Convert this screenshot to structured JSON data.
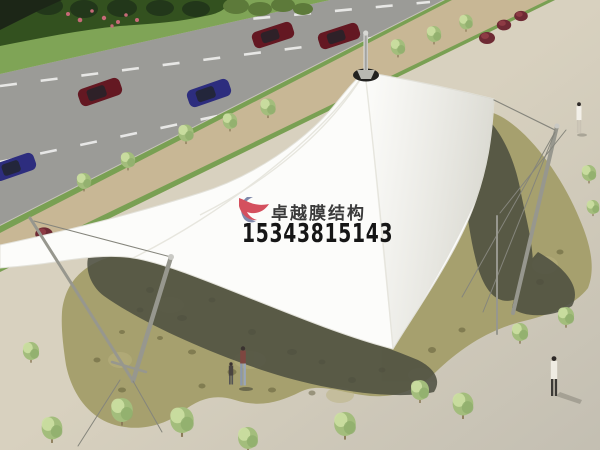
{
  "meta": {
    "description": "Aerial architectural rendering of a white tensile membrane canopy structure with a conical peak, standing over an olive flagstone plaza beside a multi-lane road",
    "style": "3D render, daytime"
  },
  "watermark": {
    "company_name": "卓越膜结构",
    "phone_number": "15343815143",
    "logo": "red and blue-gray swoosh monogram"
  },
  "scene": {
    "road": {
      "lane_markings": "white dashed lines",
      "cars": [
        "dark-teal",
        "dark-red",
        "dark-red",
        "dark-red",
        "blue",
        "navy"
      ]
    },
    "landscaping": {
      "street_trees": 8,
      "plaza_trees": 12,
      "burgundy_bushes": 7,
      "hedge": "dark green hedge with pink flowers, top-left"
    },
    "structure": {
      "membrane": "white tensile canopy with curved cable edges",
      "peak": "conical peak with dark collar and silver finial mast",
      "masts": "two tilted steel masts with guy cables"
    },
    "people": [
      "adult with child walking under canopy",
      "pedestrian in white, upper right plaza",
      "pedestrian in white coat, lower right plaza"
    ]
  },
  "colors": {
    "plaza": "#d8d1bf",
    "road": "#9b9b97",
    "roadLine": "#f0f0ee",
    "grass": "#7fa456",
    "grassStrip": "#79a053",
    "hedge": "#33511f",
    "hedgeDark": "#22371a",
    "flower": "#c66a78",
    "sidewalk": "#c8b795",
    "stone": "#a6a06e",
    "stoneSpot": "#55512f",
    "stoneLight": "#b9b27f",
    "shadow": "#4b4d3f",
    "canopy": "#fcfcfa",
    "ridge": "#e2e1d8",
    "collar": "#222220",
    "mast": "#97978e",
    "cable": "#85857c",
    "treeCrown": "#a3bd7c",
    "treeLight": "#ccdfa2",
    "treeDark": "#8fae6c",
    "trunk": "#8b7b58",
    "bushRed": "#6e2a34",
    "bushRedLight": "#8d3b44",
    "carRed": "#641822",
    "carBlue": "#2d2d7e",
    "carTeal": "#24424a",
    "carWindow": "#20242a"
  }
}
